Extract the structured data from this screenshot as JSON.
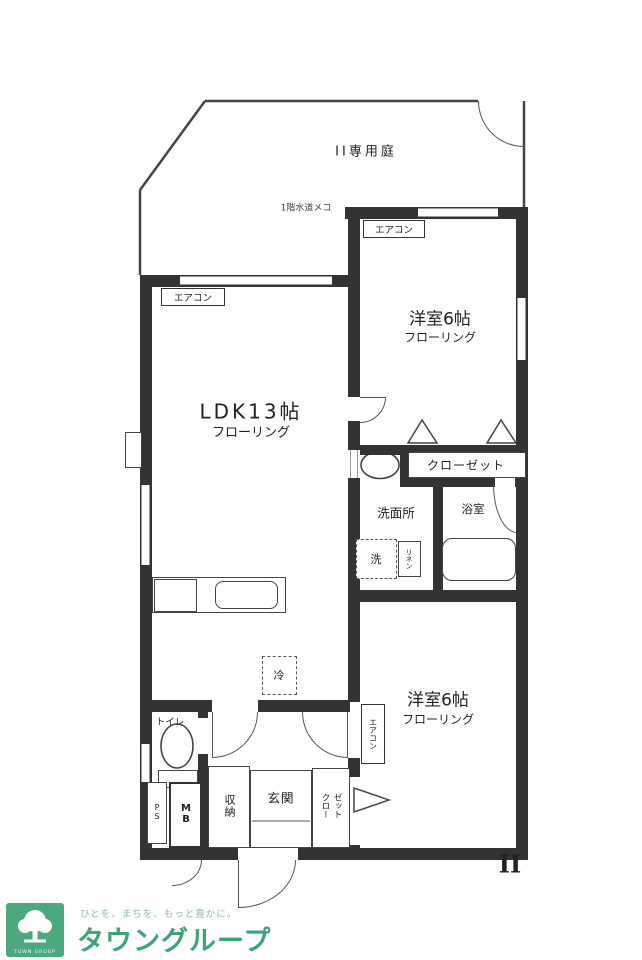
{
  "floorplan": {
    "garden": {
      "label": "II専用庭",
      "water_note": "1階水道メコ"
    },
    "aircon": "エアコン",
    "bedroom1": {
      "name": "洋室6帖",
      "floor": "フローリング"
    },
    "ldk": {
      "name": "LDK13帖",
      "floor": "フローリング"
    },
    "closet1": "クローゼット",
    "washroom": {
      "label": "洗面所",
      "washer": "洗",
      "linen": "リネン"
    },
    "bath": {
      "label": "浴室"
    },
    "bedroom2": {
      "name": "洋室6帖",
      "floor": "フローリング"
    },
    "toilet": "トイレ",
    "pipe_space": "PS",
    "meter_box": "MB",
    "storage": "収納",
    "entrance": "玄関",
    "closet2": {
      "col1": "クロー",
      "col2": "ゼット"
    },
    "fridge": "冷",
    "unit_mark": "II"
  },
  "footer": {
    "tagline": "ひとを、まちを、もっと豊かに。",
    "brand": "タウングループ",
    "logo_text": "TOWN GROUP"
  },
  "colors": {
    "wall": "#333333",
    "brand_green": "#3da478",
    "logo_bg": "#4aa97d"
  }
}
